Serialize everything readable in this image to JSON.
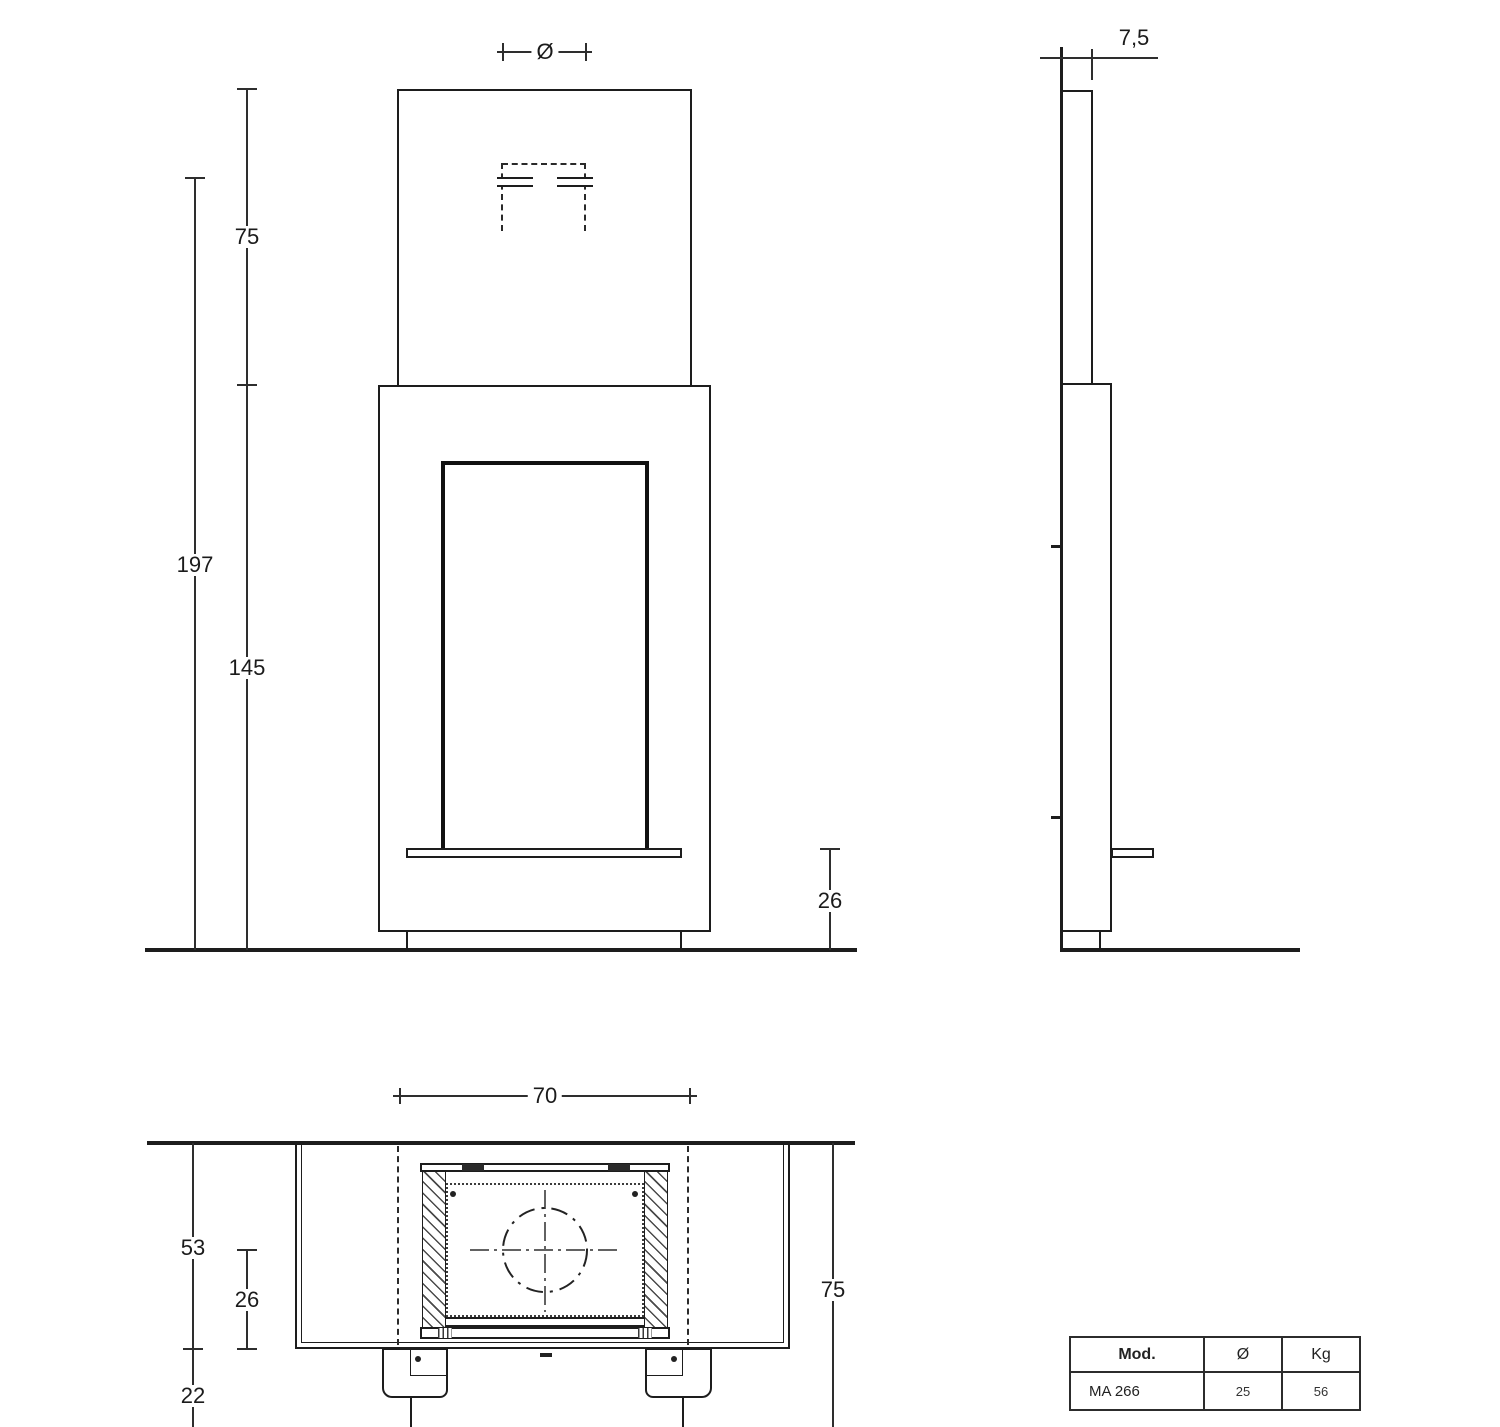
{
  "front_view": {
    "flue_dia_label": "Ø",
    "chimney_height": "75",
    "total_height": "197",
    "body_height": "145",
    "hearth_height": "26"
  },
  "side_view": {
    "depth": "7,5"
  },
  "plan_view": {
    "width": "70",
    "depth_total": "53",
    "depth_inner": "26",
    "front_offset": "22",
    "side_height": "75"
  },
  "spec_table": {
    "headers": [
      "Mod.",
      "Ø",
      "Kg"
    ],
    "rows": [
      [
        "MA 266",
        "25",
        "56"
      ]
    ]
  }
}
